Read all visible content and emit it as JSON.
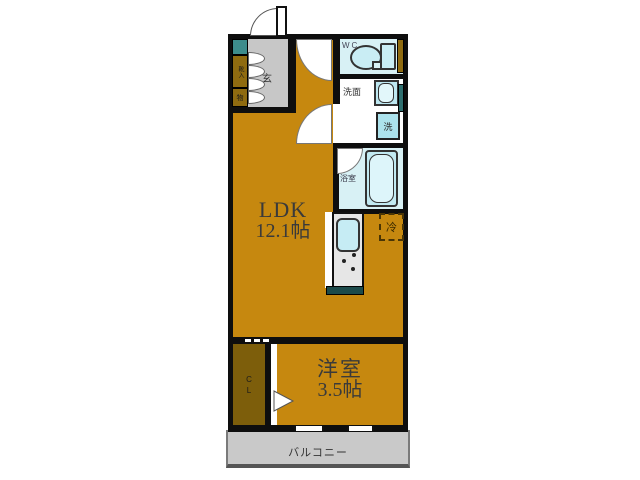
{
  "rooms": {
    "ldk": {
      "label": "LDK",
      "size": "12.1帖"
    },
    "western_room": {
      "label": "洋室",
      "size": "3.5帖"
    },
    "balcony": {
      "label": "バルコニー"
    },
    "entrance": {
      "label": "玄"
    },
    "wc": {
      "label": "WC"
    },
    "washroom": {
      "label": "洗面"
    },
    "bathroom": {
      "label": "浴室"
    },
    "closet": {
      "label": "CL"
    },
    "shoe_cabinet": {
      "label": "靴入"
    },
    "storage": {
      "label": "物"
    }
  },
  "fixtures": {
    "washer": {
      "label": "洗"
    },
    "refrigerator": {
      "label": "冷"
    }
  },
  "colors": {
    "floor_orange": "#C6880F",
    "closet_floor": "#7D5E0B",
    "wet_room_blue": "#D8F1F5",
    "fixture_blue": "#BEE8F1",
    "entrance_gray": "#C7C7C7",
    "balcony_gray": "#C9C9C9",
    "teal_accent": "#2F6F6F",
    "gold_accent": "#8F6B10",
    "wall_black": "#0E0E0E"
  }
}
